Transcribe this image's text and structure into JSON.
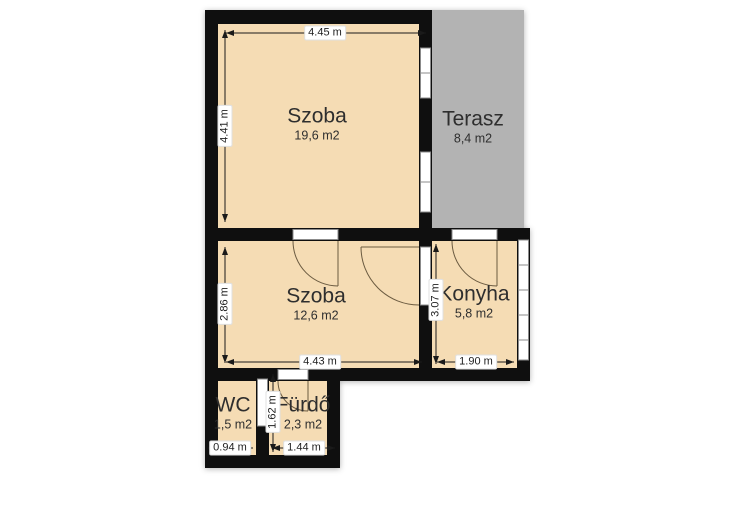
{
  "rooms": {
    "szoba1": {
      "name": "Szoba",
      "area": "19,6 m2"
    },
    "terasz": {
      "name": "Terasz",
      "area": "8,4 m2"
    },
    "szoba2": {
      "name": "Szoba",
      "area": "12,6 m2"
    },
    "konyha": {
      "name": "Konyha",
      "area": "5,8 m2"
    },
    "wc": {
      "name": "WC",
      "area": "1,5 m2"
    },
    "furdo": {
      "name": "Fürdő",
      "area": "2,3 m2"
    }
  },
  "dimensions": {
    "szoba1_width": "4.45 m",
    "szoba1_depth": "4.41 m",
    "szoba2_depth": "2.86 m",
    "szoba2_width": "4.43 m",
    "konyha_depth": "3.07 m",
    "konyha_width": "1.90 m",
    "wc_width": "0.94 m",
    "furdo_depth": "1.62 m",
    "furdo_width": "1.44 m"
  },
  "colors": {
    "floor": "#f5dcb4",
    "terrace": "#b3b3b3",
    "wall": "#0f0f0f",
    "door_arc": "#6b5b41",
    "frame": "#8b8b8b",
    "dimension_line": "#1a1a1a",
    "room_text": "#2e2e2e"
  }
}
